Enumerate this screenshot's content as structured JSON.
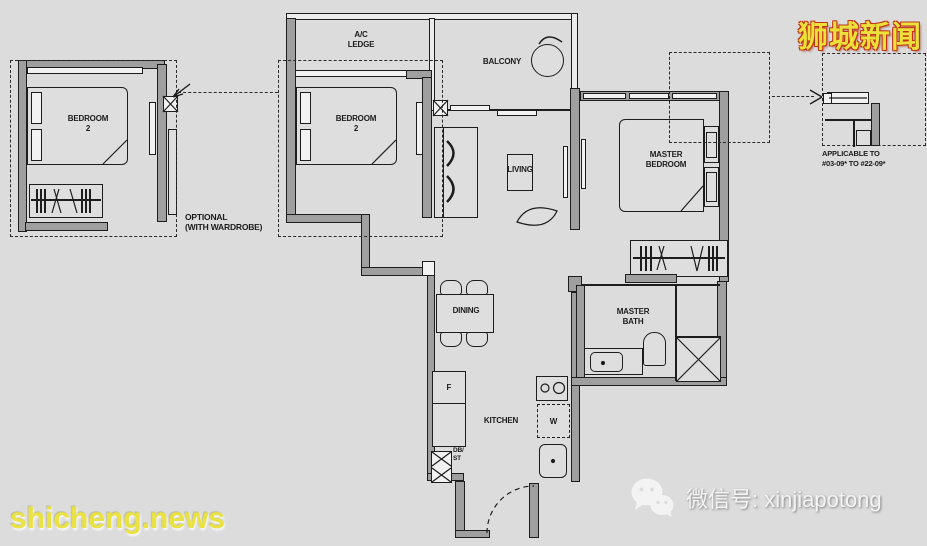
{
  "watermark": {
    "brand_cn": "狮城新闻",
    "site_url": "shicheng.news",
    "wechat_text": "微信号: xinjiapotong"
  },
  "labels": {
    "ac_ledge_1": "A/C",
    "ac_ledge_2": "LEDGE",
    "balcony": "BALCONY",
    "bedroom2_1": "BEDROOM",
    "bedroom2_2": "2",
    "living": "LIVING",
    "master_bedroom_1": "MASTER",
    "master_bedroom_2": "BEDROOM",
    "master_bath_1": "MASTER",
    "master_bath_2": "BATH",
    "dining": "DINING",
    "kitchen": "KITCHEN",
    "fridge": "F",
    "washer": "W",
    "dbst_1": "DB/",
    "dbst_2": "ST",
    "optional_1": "OPTIONAL",
    "optional_2": "(WITH WARDROBE)",
    "applicable_1": "APPLICABLE TO",
    "applicable_2": "#03-09* TO #22-09*"
  },
  "colors": {
    "background": "#dcdcdc",
    "wall": "#9f9f9f",
    "line": "#1d1d1d",
    "watermark_yellow": "#ece13a",
    "watermark_red_outline": "#c23318",
    "watermark_white": "#f3f3f3"
  }
}
